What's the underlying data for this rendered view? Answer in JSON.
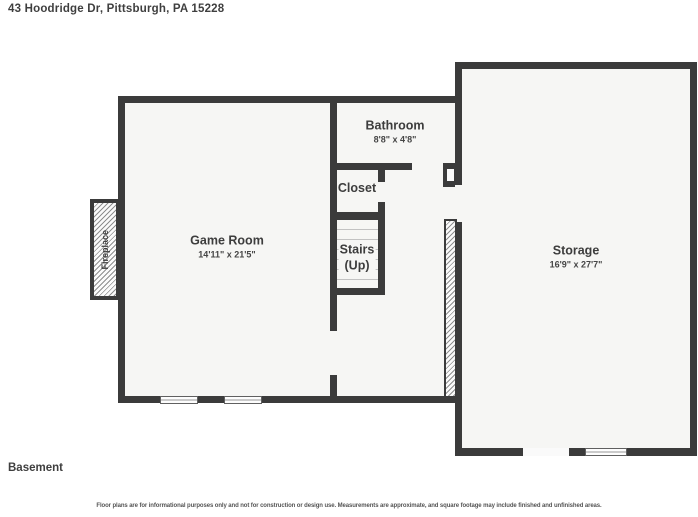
{
  "header": {
    "address": "43 Hoodridge Dr, Pittsburgh, PA 15228"
  },
  "floor": {
    "label": "Basement"
  },
  "footer": {
    "disclaimer": "Floor plans are for informational purposes only and not for construction or design use. Measurements are approximate, and square footage may include finished and unfinished areas."
  },
  "rooms": {
    "game_room": {
      "name": "Game Room",
      "dimensions": "14'11\" x 21'5\""
    },
    "bathroom": {
      "name": "Bathroom",
      "dimensions": "8'8\" x 4'8\""
    },
    "closet": {
      "name": "Closet"
    },
    "stairs": {
      "name": "Stairs",
      "direction": "(Up)"
    },
    "storage": {
      "name": "Storage",
      "dimensions": "16'9\" x 27'7\""
    },
    "fireplace": {
      "name": "Fireplace"
    }
  },
  "colors": {
    "wall": "#3b3b3b",
    "floor": "#f6f6f4",
    "text": "#3d3d3d"
  }
}
